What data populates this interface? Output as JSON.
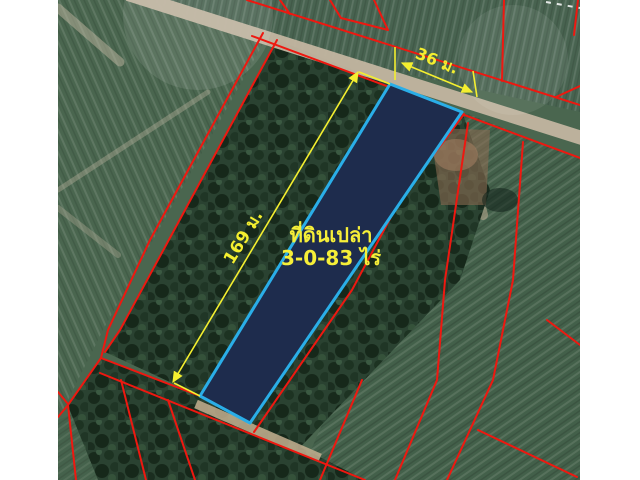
{
  "image": {
    "type": "satellite-cadastral-map",
    "letterbox_color": "#ffffff"
  },
  "map": {
    "annotations": {
      "width_label": "36 ม.",
      "length_label": "169 ม.",
      "parcel_title": "ที่ดินเปล่า",
      "parcel_area": "3-0-83 ไร่"
    },
    "parcel": {
      "width_m": 36,
      "length_m": 169,
      "area_rai": "3-0-83"
    },
    "colors": {
      "cadastral_line_red": "#ee1810",
      "parcel_fill_navy": "#1e2c4d",
      "parcel_border_cyan": "#2aaee8",
      "annotation_yellow": "#f4ef2f",
      "field_green": "#4a664f",
      "tree_green": "#2a4231",
      "road_tan": "#c3b6a1"
    }
  }
}
